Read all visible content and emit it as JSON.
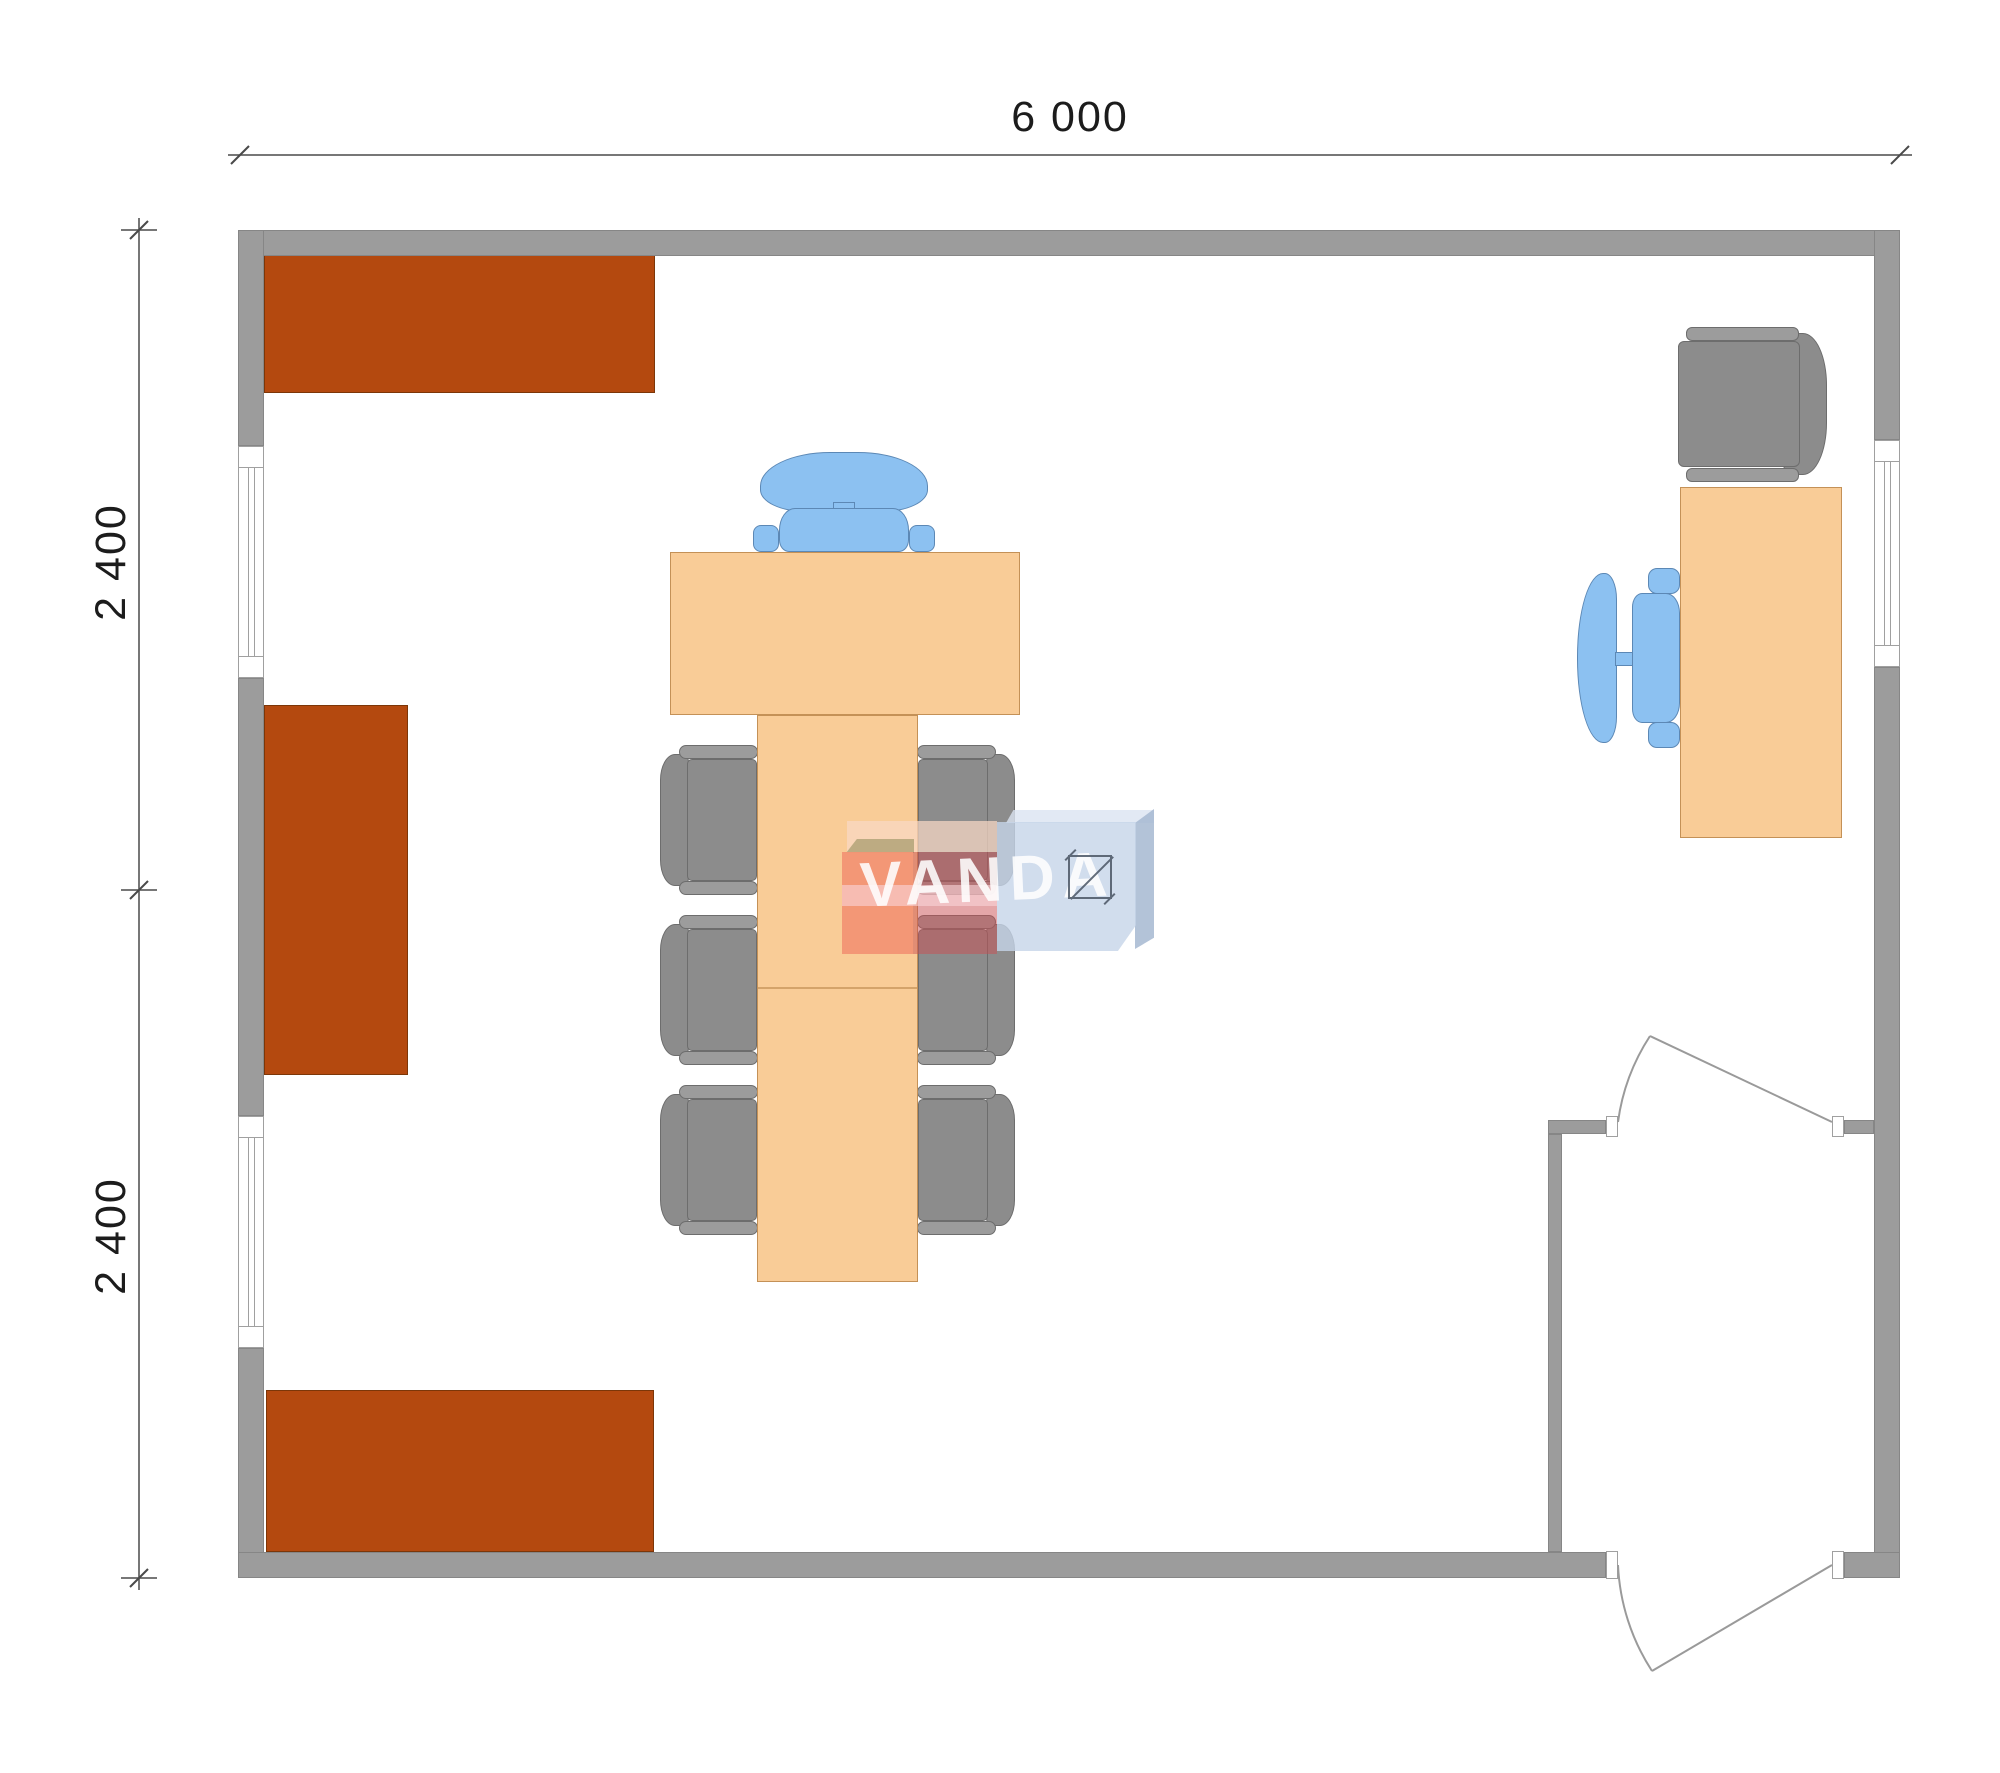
{
  "plan": {
    "dimensions": {
      "width_label": "6 000",
      "height_upper_label": "2 400",
      "height_lower_label": "2 400"
    },
    "watermark_text": "VANDA",
    "colors": {
      "wall": "#9c9c9c",
      "wallOutline": "#868686",
      "windowFrame": "#a0a0a0",
      "cabinet": "#b4490f",
      "cabinetOutline": "#7c3608",
      "table": "#f9cc97",
      "tableOutline": "#c49157",
      "chairGray": "#8c8c8c",
      "chairGrayLight": "#9c9c9c",
      "chairGrayOutline": "#6d6d6d",
      "chairBlue": "#8cc1f1",
      "chairBlueOutline": "#5c88b5",
      "dimension": "#1c1c1c",
      "dimLine": "#4a4a4a",
      "door": "#9a9a9a",
      "logoSalmon": "#f29474",
      "logoTan": "#b6a67c",
      "logoRed": "#c94e52",
      "logoPink": "#f8d3d6",
      "logoPeach": "#f8d8c5",
      "logoBlue": "#c5d4e9",
      "logoBlueSide": "#a6b8d1",
      "logoBlueTop": "#dbe4f1",
      "logoText": "#ffffff",
      "squareIcon": "#4a5564"
    }
  }
}
